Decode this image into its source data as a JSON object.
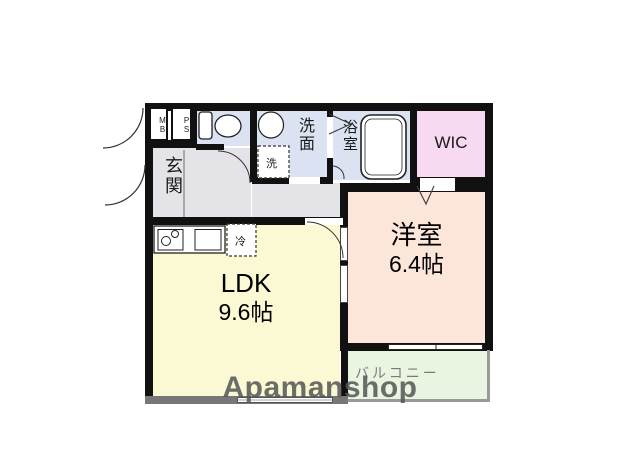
{
  "plan": {
    "mb_label": "MB",
    "ps_label": "PS",
    "entrance": {
      "label": "玄関"
    },
    "washroom": {
      "label": "洗面"
    },
    "washing_machine": {
      "label": "洗"
    },
    "bathroom": {
      "label": "浴室"
    },
    "wic": {
      "label": "WIC"
    },
    "western_room": {
      "label": "洋室",
      "size": "6.4帖"
    },
    "ldk": {
      "label": "LDK",
      "size": "9.6帖"
    },
    "balcony": {
      "label": "バルコニー"
    },
    "refrigerator": {
      "label": "冷"
    }
  },
  "watermark": "Apamanshop",
  "colors": {
    "wall": "#111111",
    "wet_rooms": "#dbe3f2",
    "wic": "#f8d9f2",
    "western_room": "#fce5d9",
    "ldk": "#fbf9d4",
    "balcony": "#e9f4e1",
    "hallway": "#e4e4e8",
    "ldk_outer_wall": "#777777",
    "watermark_text": "#555555"
  }
}
